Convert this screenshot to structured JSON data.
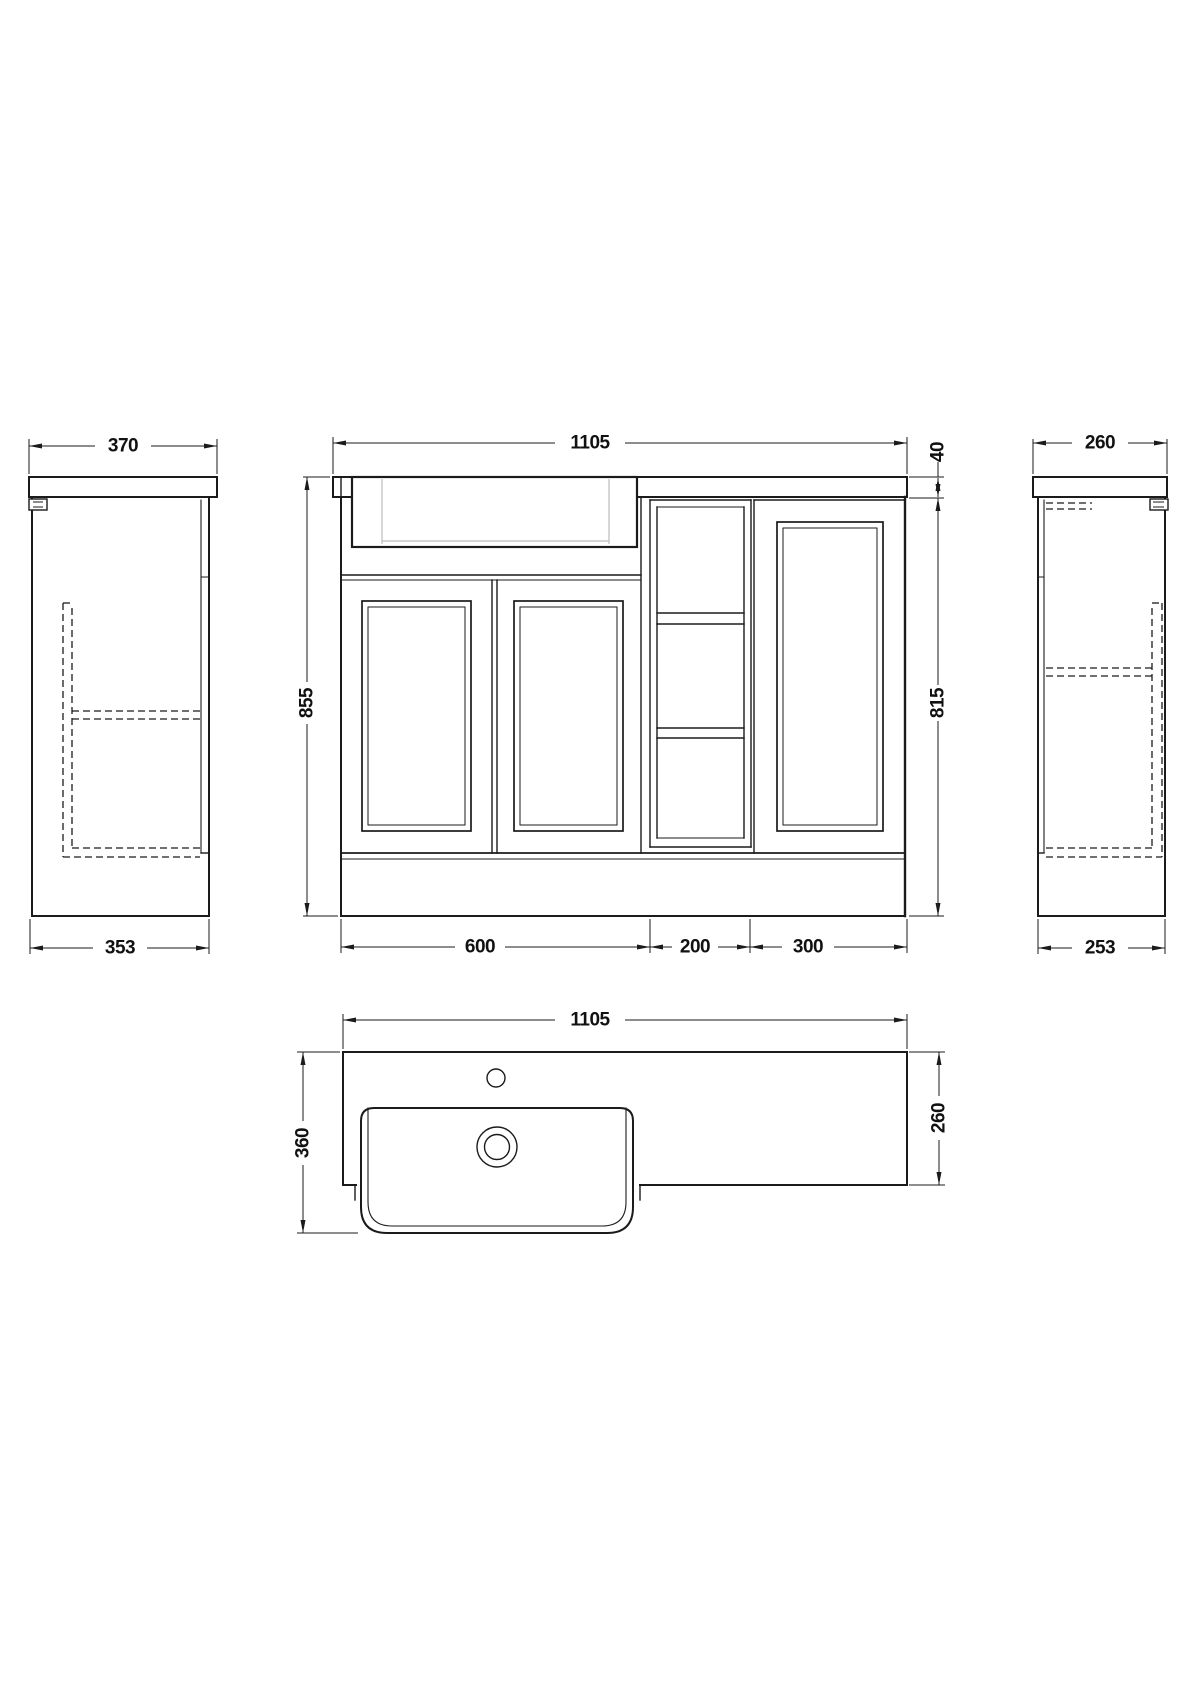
{
  "colors": {
    "line": "#1b1b1b",
    "basin_inner_line": "#bcbcbc",
    "background": "#ffffff"
  },
  "views": {
    "left_side": {
      "counter_depth": "370",
      "cabinet_depth": "353"
    },
    "front": {
      "overall_width": "1105",
      "overall_height": "855",
      "worktop_thickness": "40",
      "cabinet_height": "815",
      "basin_unit_width": "600",
      "open_shelf_width": "200",
      "wc_unit_width": "300"
    },
    "right_side": {
      "counter_depth": "260",
      "cabinet_depth": "253"
    },
    "plan": {
      "overall_width": "1105",
      "overall_depth": "360",
      "worktop_depth": "260"
    }
  }
}
